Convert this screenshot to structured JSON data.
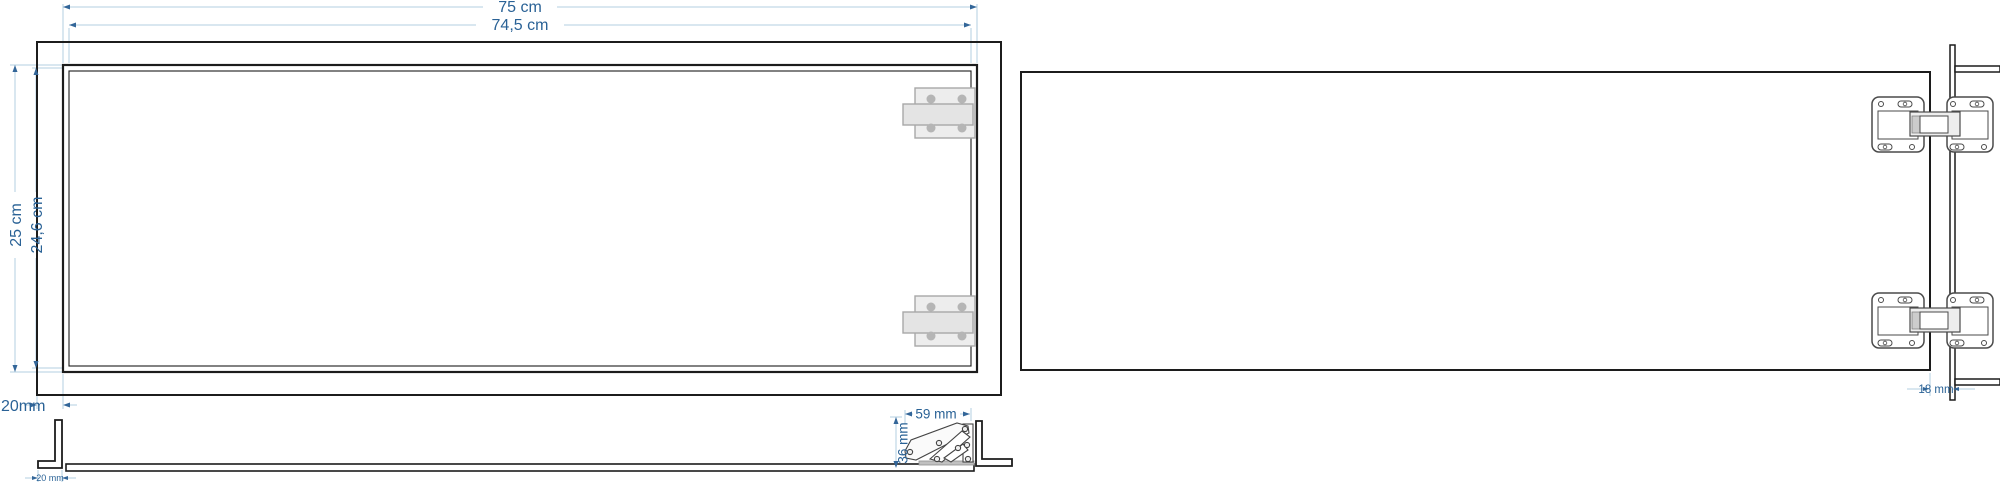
{
  "drawing": {
    "front_view": {
      "dim_width_outer": "75 cm",
      "dim_width_inner": "74,5 cm",
      "dim_height_outer": "25 cm",
      "dim_height_inner": "24,6 cm",
      "dim_frame_offset": "20mm"
    },
    "section_view": {
      "dim_angle_foot": "20 mm",
      "dim_hinge_length": "59 mm",
      "dim_hinge_height": "36 mm"
    },
    "back_view": {
      "dim_edge_gap": "18 mm"
    },
    "colors": {
      "outline": "#1c1c1c",
      "dim_line": "#b3cfe2",
      "dim_text": "#2a6296",
      "arrow": "#336699",
      "hinge_plate_fill": "#ededed",
      "hinge_screw_fill": "#b5b5b5",
      "hinge_outline": "#4a4a4a"
    }
  }
}
